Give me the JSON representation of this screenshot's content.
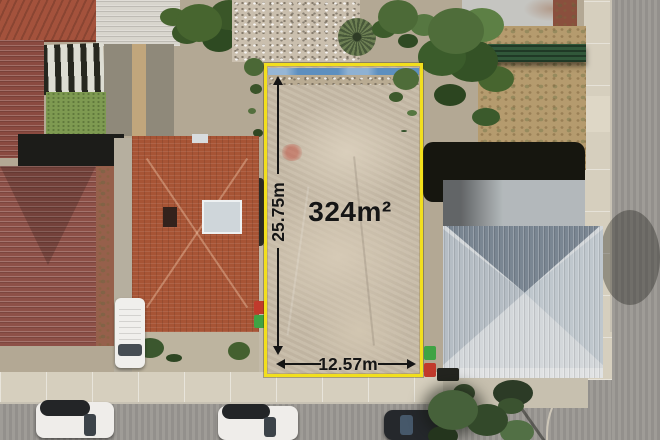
{
  "annotations": {
    "area_label": "324m²",
    "depth_label": "25.75m",
    "frontage_label": "12.57m"
  },
  "colors": {
    "boundary_yellow": "#f2df1d",
    "annotation_text": "#151515",
    "lot_dirt": "#c6baa7",
    "terracotta_roof": "#a75435",
    "maroon_roof": "#8d5047",
    "silver_roof_light": "#d3d7da",
    "silver_roof_dark": "#7a8692",
    "road_asphalt": "#9b9893",
    "footpath_concrete": "#d6cfbe",
    "tree_canopy": "#4d6b39",
    "lawn_green": "#7e9a51",
    "yard_dirt": "#b59b6e",
    "pool_tarp_blue": "#5d8fbf",
    "bin_green": "#3fa344",
    "bin_red": "#c13a2c",
    "vehicle_white": "#efedea",
    "vehicle_dark": "#25282c"
  }
}
